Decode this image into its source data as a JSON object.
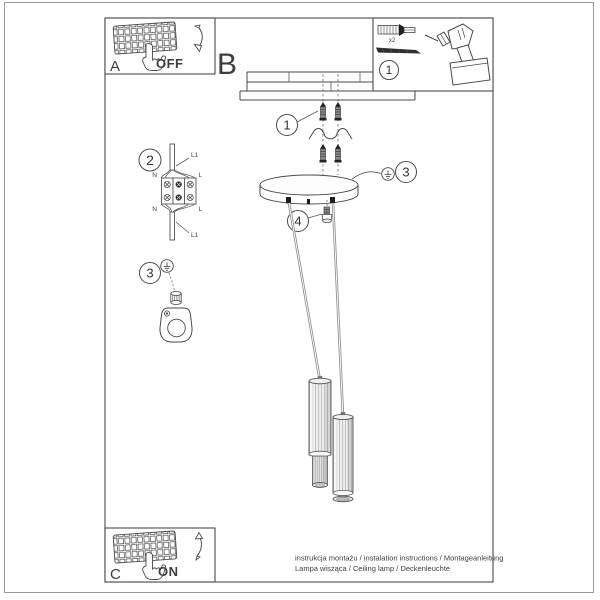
{
  "letters": {
    "a": "A",
    "b": "B",
    "c": "C"
  },
  "switch": {
    "off": "OFF",
    "on": "ON"
  },
  "steps": {
    "one": "1",
    "two": "2",
    "three": "3",
    "four": "4"
  },
  "tools": {
    "anchor_quantity": "x2"
  },
  "wiring": {
    "line_top": "L1",
    "line_bottom": "L1",
    "neutral_top": "N",
    "neutral_bottom": "N",
    "live_top": "L",
    "live_bottom": "L"
  },
  "footer": {
    "line1": "instrukcja montażu / instalation instructions / Montageanleitung",
    "line2": "Lampa wisząca / Ceiling lamp / Deckenleuchte"
  },
  "colors": {
    "line": "#4a4a4a",
    "frame": "#9a9a9a",
    "cable": "#8f8f8f",
    "shade_fill": "#ececec",
    "text": "#3d3d3d"
  }
}
